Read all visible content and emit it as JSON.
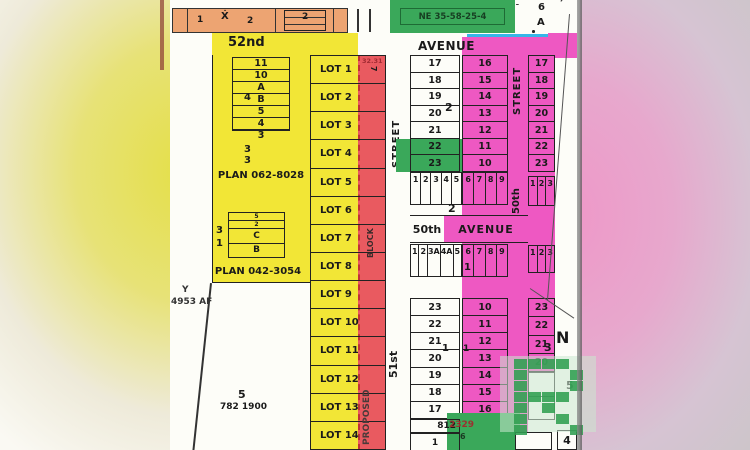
{
  "colors": {
    "yellow": "#f2e636",
    "pink": "#ee58c2",
    "red": "#e95a60",
    "orange": "#eda472",
    "green": "#3aa85a",
    "cyan": "#36b6e8",
    "watermark_green": "#2f9e50"
  },
  "header": {
    "clipped_left": "SCALE 1:2000",
    "clipped_mid": "2021",
    "clipped_right": "ST. WILSON, ALTA",
    "quarter_label": "NE 35-58-25-4",
    "corner_lot_number": "6",
    "corner_block_letter": "A",
    "strip_cells": [
      "1",
      "Ẋ",
      "2"
    ],
    "strip_box_label": "2"
  },
  "streets": {
    "fifty_second": "52nd",
    "avenue_upper": "AVENUE",
    "street_51_label": "STREET",
    "street_51_name": "51st",
    "street_50_label": "STREET",
    "street_50_name": "50th",
    "avenue_50_name": "50th",
    "avenue_50_label": "AVENUE",
    "north_arrow": "N"
  },
  "left_block": {
    "box1_rows": [
      "11",
      "10",
      "A",
      "B",
      "5",
      "4",
      "3"
    ],
    "box1_side": "4",
    "plan1_lot_top": "3",
    "plan1_lot_bottom": "3",
    "plan1": "PLAN 062-8028",
    "box2_rows": [
      "5",
      "2",
      "C",
      "B"
    ],
    "box2_side_top": "3",
    "box2_side_bottom": "1",
    "plan2": "PLAN 042-3054",
    "y_marker": "Y",
    "af_marker": "4953 AF",
    "parcel_number": "5",
    "parcel_plan": "782 1900"
  },
  "yellow_lots": [
    "LOT 1",
    "LOT 2",
    "LOT 3",
    "LOT 4",
    "LOT 5",
    "LOT 6",
    "LOT 7",
    "LOT 8",
    "LOT 9",
    "LOT 10",
    "LOT 11",
    "LOT 12",
    "LOT 13",
    "LOT 14"
  ],
  "red_strip": {
    "dim_label": "32.31",
    "lot7": "7",
    "block_label": "BLOCK",
    "proposed_label": "PROPOSED"
  },
  "grid": {
    "west_top": [
      "17",
      "18",
      "19",
      "20",
      "21",
      "22",
      "23"
    ],
    "west_top_block": "2",
    "east_top": [
      "16",
      "15",
      "14",
      "13",
      "12",
      "11",
      "10"
    ],
    "far_east_top": [
      "17",
      "18",
      "19",
      "20",
      "21",
      "22",
      "23"
    ],
    "mid_upper_west": [
      "1",
      "2",
      "3",
      "4",
      "5"
    ],
    "mid_upper_east": [
      "6",
      "7",
      "8",
      "9"
    ],
    "mid_upper_far": [
      "1",
      "2",
      "3"
    ],
    "mid_upper_block": "2",
    "mid_lower_west": [
      "1",
      "2",
      "3A",
      "4A",
      "5"
    ],
    "mid_lower_east": [
      "6",
      "7",
      "8",
      "9"
    ],
    "mid_lower_far": [
      "1",
      "2",
      "3"
    ],
    "mid_lower_block": "1",
    "west_bottom": [
      "23",
      "22",
      "21",
      "20",
      "19",
      "18",
      "17"
    ],
    "west_bottom_block": "1",
    "east_bottom": [
      "10",
      "11",
      "12",
      "13",
      "14",
      "15",
      "16"
    ],
    "east_bottom_block": "1",
    "far_east_bottom": [
      "23",
      "22",
      "21",
      "20"
    ],
    "far_east_block": "3",
    "plan_812": "812",
    "plan_2329": "2329",
    "bottom_lot_1": "1",
    "green_lot_6": "6",
    "label_5": "5",
    "label_4": "4"
  },
  "watermark": {
    "letter": "R"
  }
}
